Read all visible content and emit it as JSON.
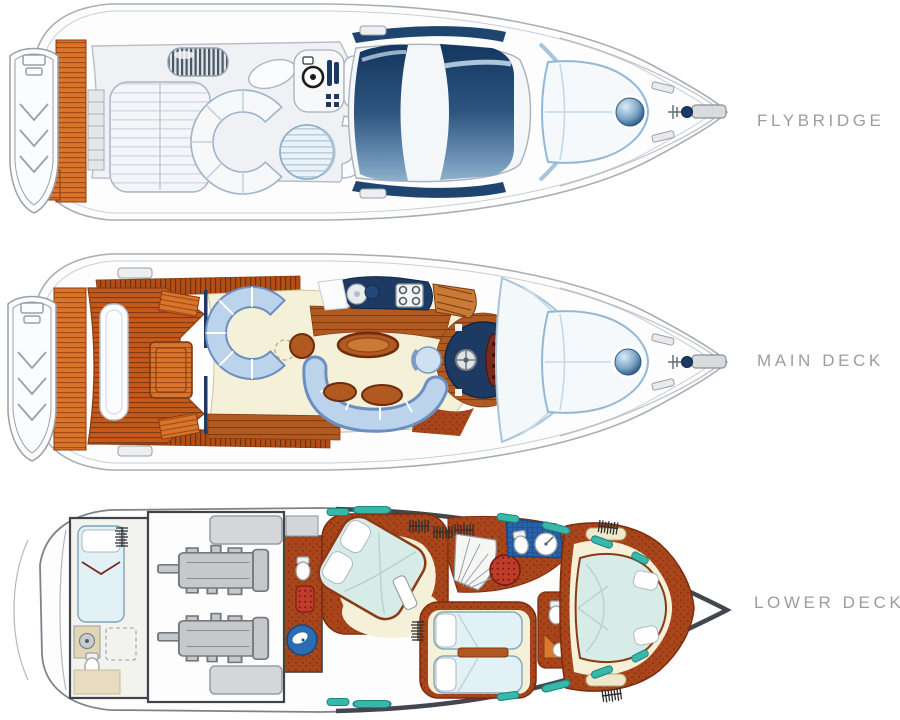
{
  "decks": [
    {
      "id": "flybridge",
      "label": "FLYBRIDGE"
    },
    {
      "id": "main-deck",
      "label": "MAIN DECK"
    },
    {
      "id": "lower-deck",
      "label": "LOWER DECK"
    }
  ],
  "palette": {
    "background": "#ffffff",
    "label_text": "#9b9da0",
    "hull_line": "#a9aeb4",
    "teak": "#c4591c",
    "teak_dark": "#7c3a10",
    "navy": "#1d3a63",
    "glass_top": "#14365f",
    "glass_bottom": "#8fb0ca",
    "sofa_blue": "#bcd3ec",
    "sofa_edge": "#6b8fc2",
    "cream": "#f5f1d8",
    "wood": "#b05a22",
    "carpet": "#a9451b",
    "mattress": "#d7ebe7",
    "bed_blue": "#e2f1f6",
    "teal": "#3ab7ab",
    "maroon": "#7c2a1e",
    "seat_red": "#bf3b2a",
    "engine_gray": "#c6c9cc",
    "tank_gray": "#d4d7da",
    "sphere_blue": "#1c4a78"
  }
}
